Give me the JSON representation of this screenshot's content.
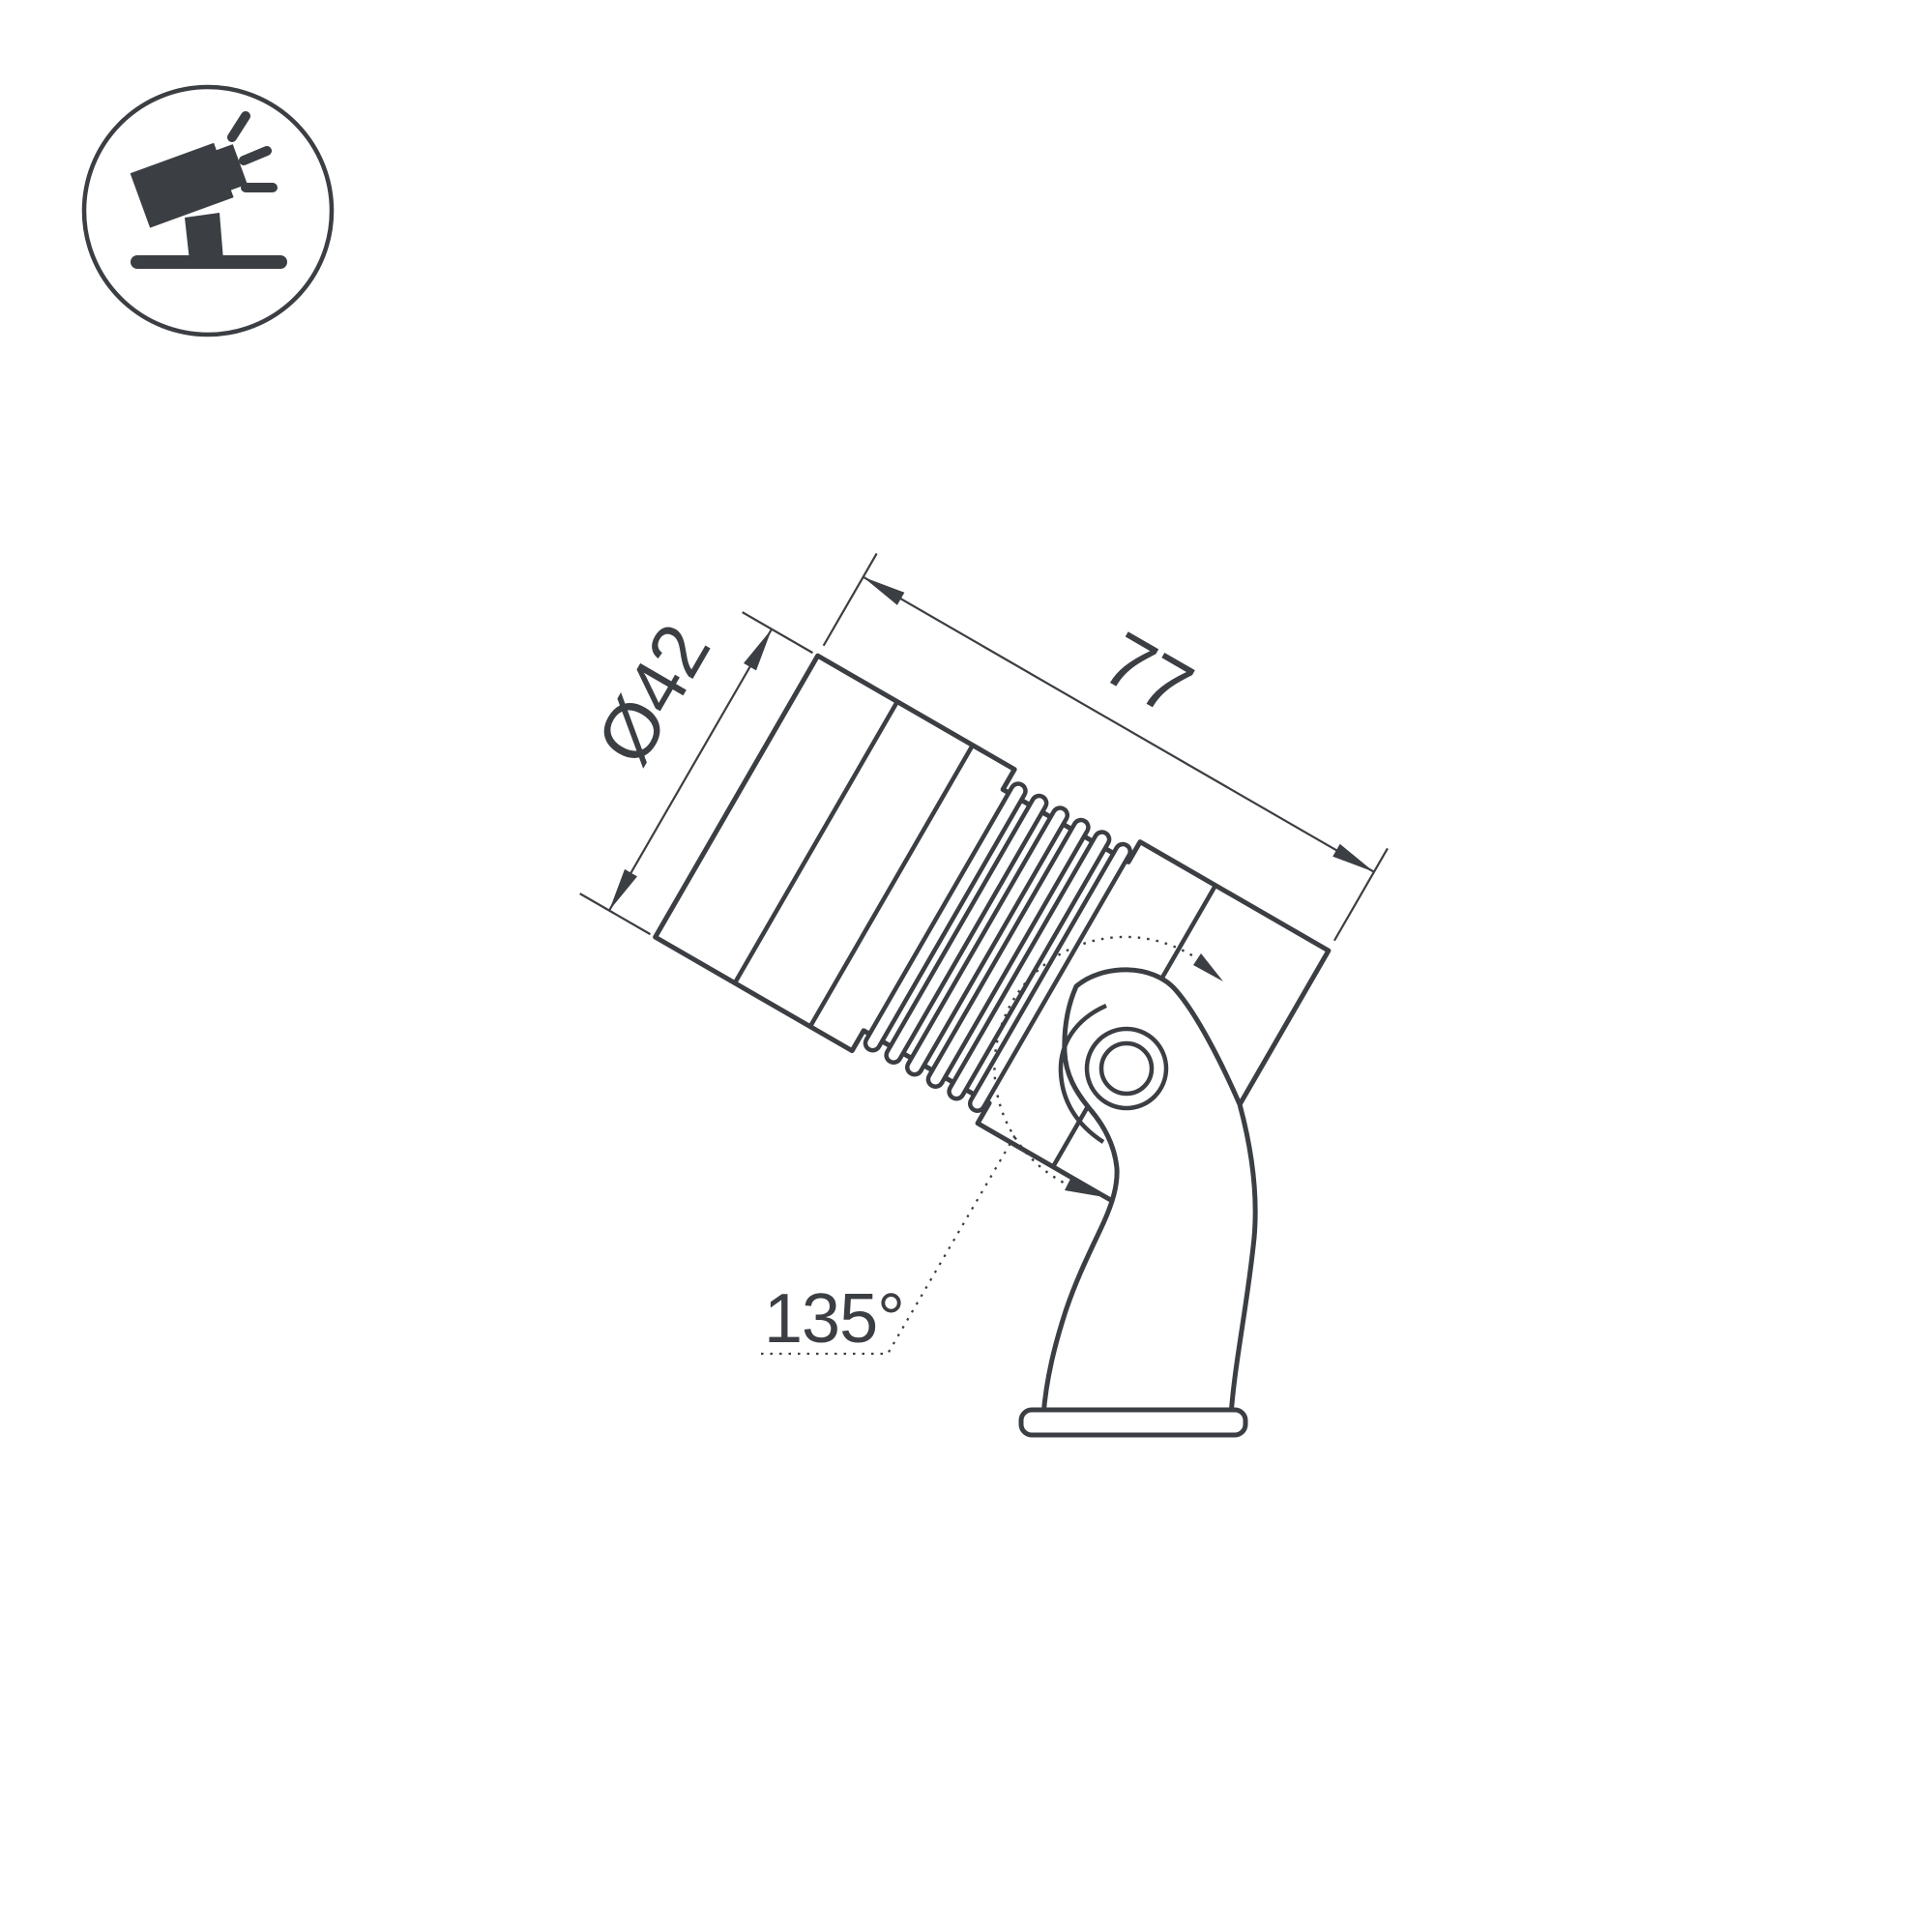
{
  "colors": {
    "background": "#ffffff",
    "ink": "#3b3e42"
  },
  "badge": {
    "icon": "tilted-spotlight-on-stand-icon"
  },
  "dimensions": {
    "diameter_label": "Ø42",
    "length_label": "77",
    "angle_label": "135°"
  }
}
